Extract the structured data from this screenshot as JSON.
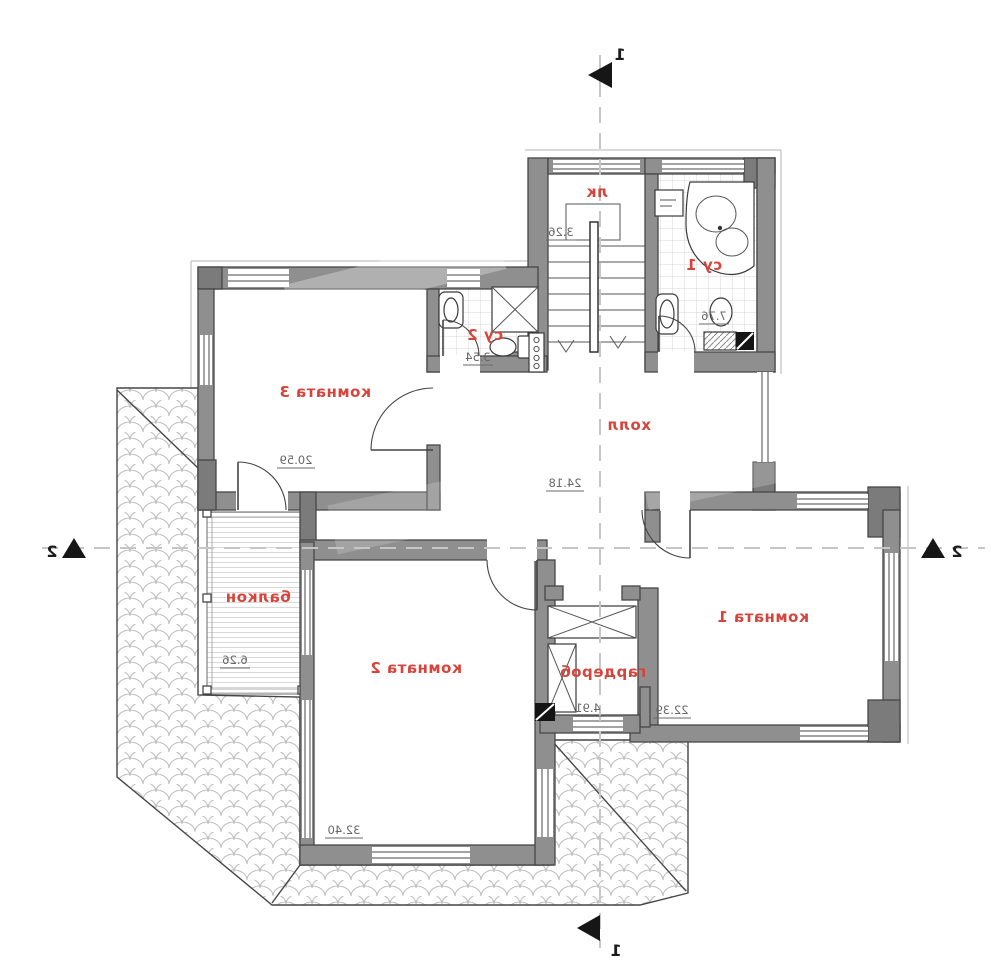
{
  "plan": {
    "type": "apartment-floor-plan",
    "mirrored": true,
    "colors": {
      "label": "#d6453c",
      "dimension": "#686868",
      "wall": "#8f8f8f",
      "wall_dark": "#7b7b7b",
      "section_dash": "#c6c6c6"
    },
    "rooms": {
      "stairs": {
        "label": "лк",
        "area": "3.26"
      },
      "bath1": {
        "label": "су 1",
        "area": "7.76"
      },
      "bath2": {
        "label": "су 2",
        "area": "3.54"
      },
      "room3": {
        "label": "комната 3",
        "area": "20.59"
      },
      "hall": {
        "label": "холл",
        "area": "24.18"
      },
      "balcony": {
        "label": "балкон",
        "area": "6.26"
      },
      "room2": {
        "label": "комната 2",
        "area": "32.40"
      },
      "wardrobe": {
        "label": "гардероб",
        "area": "4.91"
      },
      "room1": {
        "label": "комната 1",
        "area": "22.39"
      }
    },
    "section_markers": {
      "top": "1",
      "bottom": "1",
      "left": "2",
      "right": "2"
    }
  }
}
